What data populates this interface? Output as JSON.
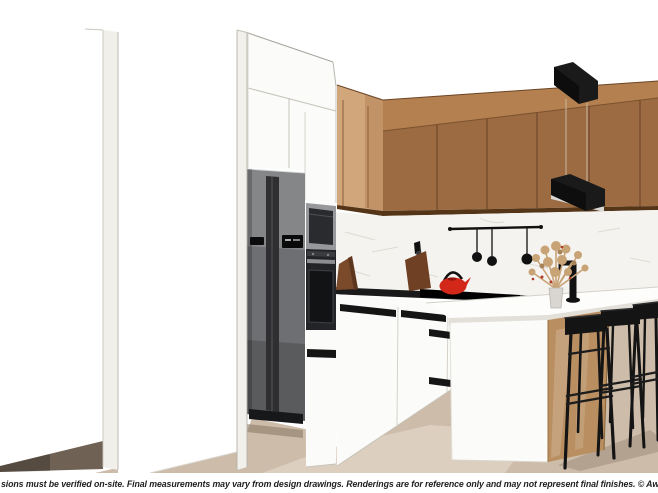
{
  "image": {
    "kind": "3D kitchen design rendering",
    "footer": {
      "disclaimer": "sions must be verified on-site. Final measurements may vary from design drawings. Renderings are for reference only and may not represent final finishes.  © Awesome Kitchens Ltd"
    }
  },
  "scene": {
    "objects": [
      "left wall partition",
      "second wall partition",
      "tall white cabinets",
      "side-by-side refrigerator",
      "built-in compact appliance",
      "built-in oven",
      "wood upper cabinets",
      "marble backsplash",
      "black countertop",
      "cooktop",
      "utensil rail with ladles",
      "red kettle",
      "cutting board with knife",
      "wooden board",
      "dried flower bouquet in vase",
      "black faucet",
      "kitchen island with white top",
      "island wood end panel",
      "black bar stools",
      "two linear pendant lights",
      "wood floor",
      "area rug",
      "floor shadow"
    ]
  },
  "colors": {
    "background": "#ffffff",
    "text": "#1e1e1e",
    "wood_doors": "#9c6b42",
    "wood_fascia": "#b4804f",
    "wood_corner": "#d0a67a",
    "wood_edge": "#553517",
    "marble": "#f5f3ef",
    "marble_vein": "#dcd7d0",
    "counter_black": "#1a1a1a",
    "cabinet_white": "#fbfbf9",
    "cabinet_line": "#c7c3ba",
    "handle_black": "#151515",
    "fridge_body": "#6e6f72",
    "fridge_gap": "#2f2f31",
    "oven_black": "#232427",
    "oven_frame": "#97989b",
    "island_wood": "#b98e60",
    "floor": "#cdbca9",
    "rug": "#dccfc0",
    "floor_shadow": "#6f6153",
    "island_shadow": "#b3a290",
    "stool_black": "#141414",
    "pendant_black": "#1a1a1a",
    "pendant_glow": "#d8d8d6",
    "cord": "#c9b9a2",
    "kettle_red": "#d3271a",
    "board_brown": "#7a4a2a",
    "flowers": "#c7a376",
    "flower_accent": "#b03a26"
  }
}
